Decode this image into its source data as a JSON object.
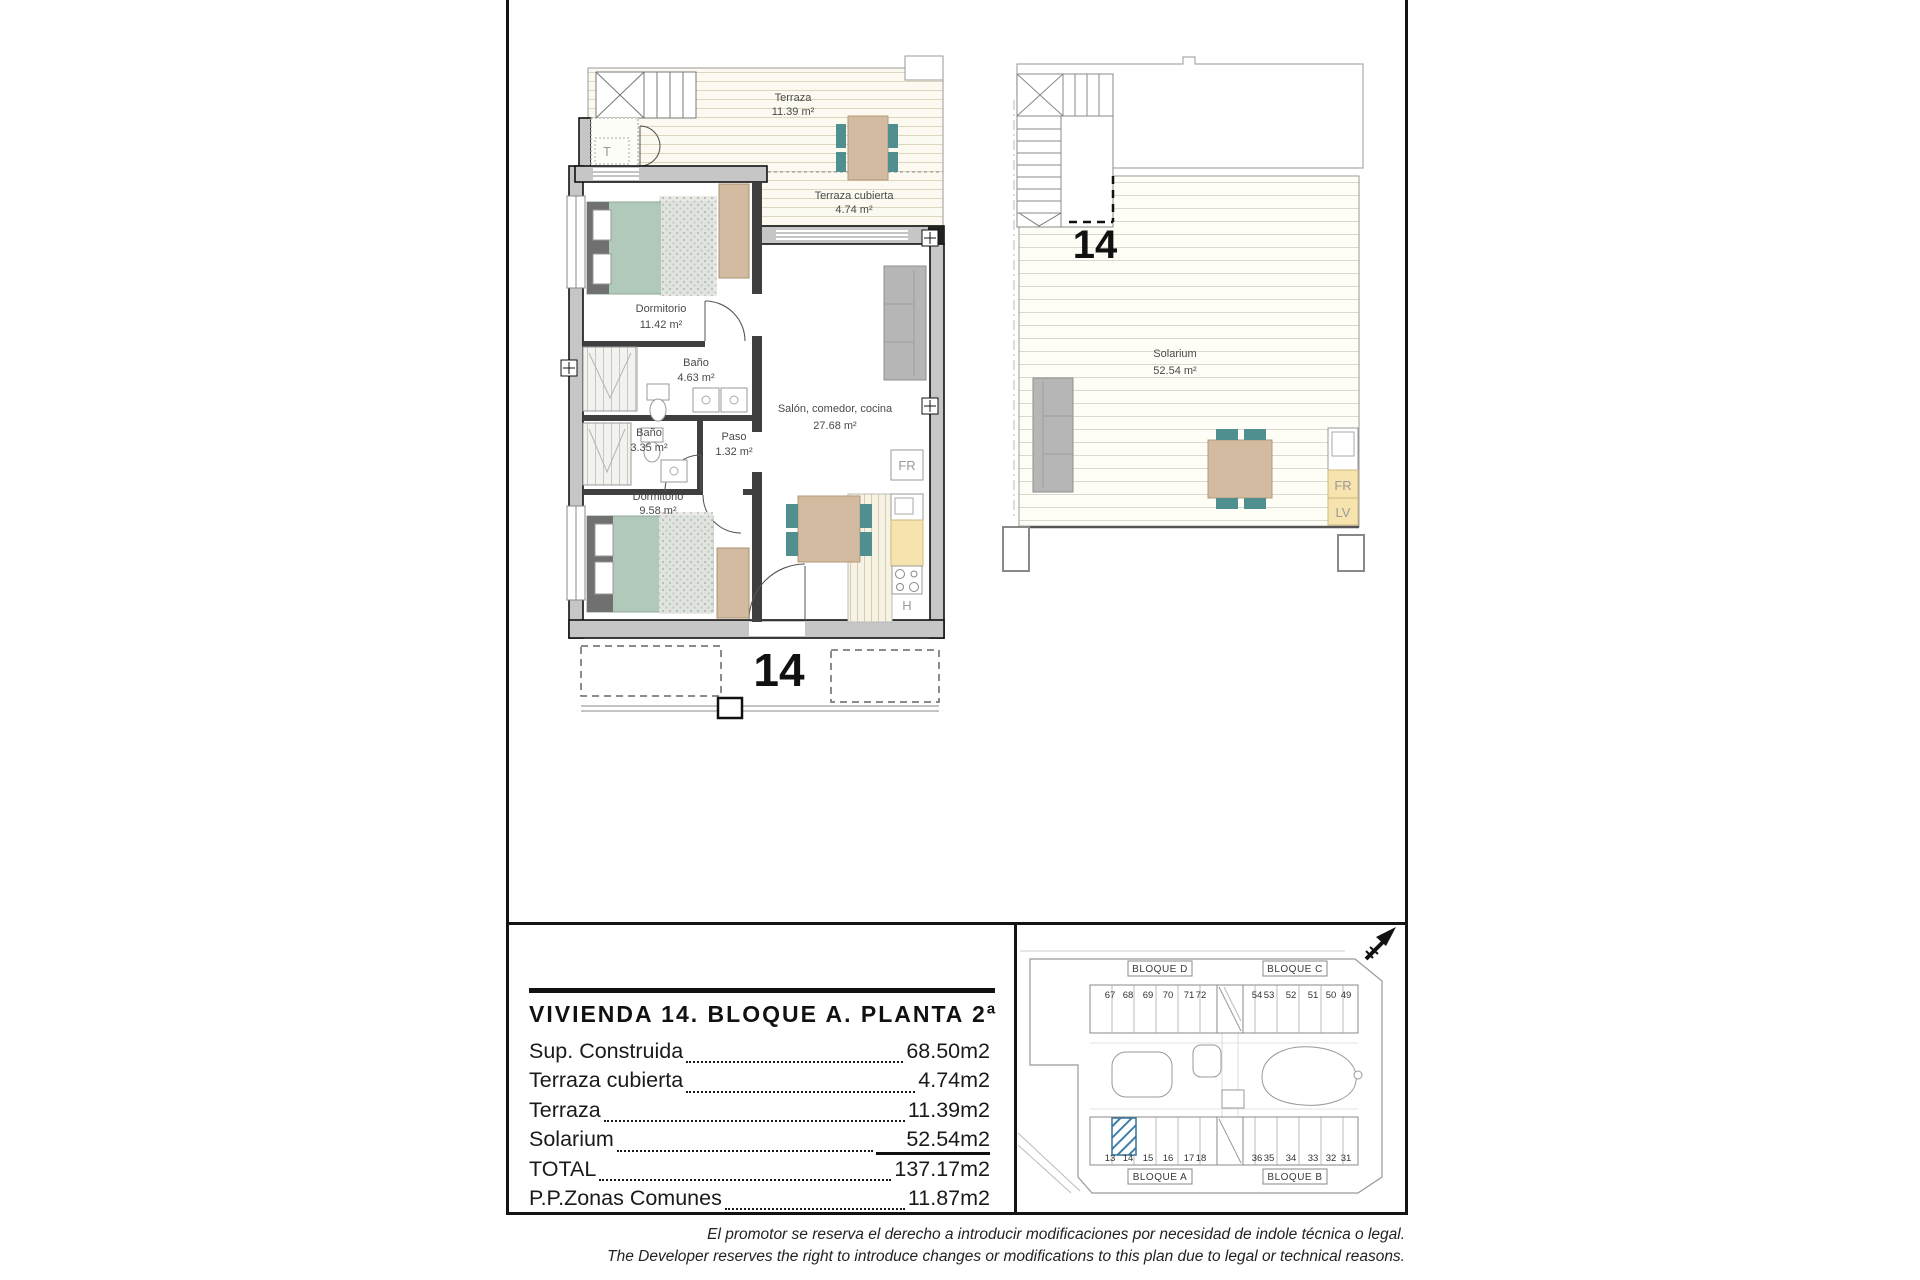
{
  "summary": {
    "title": "VIVIENDA 14. BLOQUE A. PLANTA 2ª",
    "rows": [
      {
        "label": "Sup. Construida",
        "value": "68.50m2"
      },
      {
        "label": "Terraza cubierta",
        "value": "4.74m2"
      },
      {
        "label": "Terraza",
        "value": "11.39m2"
      },
      {
        "label": "Solarium",
        "value": "52.54m2"
      },
      {
        "label": "TOTAL",
        "value": "137.17m2"
      },
      {
        "label": "P.P.Zonas Comunes",
        "value": "11.87m2"
      }
    ]
  },
  "floor_plan": {
    "rooms": [
      {
        "name": "Terraza",
        "area": "11.39 m²"
      },
      {
        "name": "Terraza cubierta",
        "area": "4.74 m²"
      },
      {
        "name": "Dormitorio",
        "area": "11.42 m²"
      },
      {
        "name": "Baño",
        "area": "4.63 m²"
      },
      {
        "name": "Baño",
        "area": "3.35 m²"
      },
      {
        "name": "Paso",
        "area": "1.32 m²"
      },
      {
        "name": "Dormitorio",
        "area": "9.58 m²"
      },
      {
        "name": "Salón, comedor, cocina",
        "area": "27.68 m²"
      }
    ],
    "labels": {
      "fr": "FR",
      "hob": "H",
      "t": "T",
      "unit": "14"
    }
  },
  "solarium_plan": {
    "room": {
      "name": "Solarium",
      "area": "52.54 m²"
    },
    "labels": {
      "fr": "FR",
      "lv": "LV",
      "unit": "14"
    }
  },
  "site_plan": {
    "blocks": [
      {
        "label": "BLOQUE D",
        "units": [
          "67",
          "68",
          "69",
          "70",
          "71",
          "72"
        ]
      },
      {
        "label": "BLOQUE C",
        "units": [
          "54",
          "53",
          "52",
          "51",
          "50",
          "49"
        ]
      },
      {
        "label": "BLOQUE A",
        "units": [
          "13",
          "14",
          "15",
          "16",
          "17",
          "18"
        ],
        "highlighted_unit": "14"
      },
      {
        "label": "BLOQUE B",
        "units": [
          "36",
          "35",
          "34",
          "33",
          "32",
          "31"
        ]
      }
    ]
  },
  "disclaimer": {
    "line1": "El promotor se reserva el derecho a introducir modificaciones por necesidad de indole técnica o legal.",
    "line2": "The Developer reserves the right to introduce changes or modifications to this plan due to legal or technical reasons."
  },
  "colors": {
    "highlight_hatch": "#4080a8",
    "bed": "#b0c9ba",
    "chair": "#4f8f8f",
    "wood": "#d2bba1",
    "counter": "#f6e3ae",
    "wall_fill": "#c6c6c6"
  }
}
